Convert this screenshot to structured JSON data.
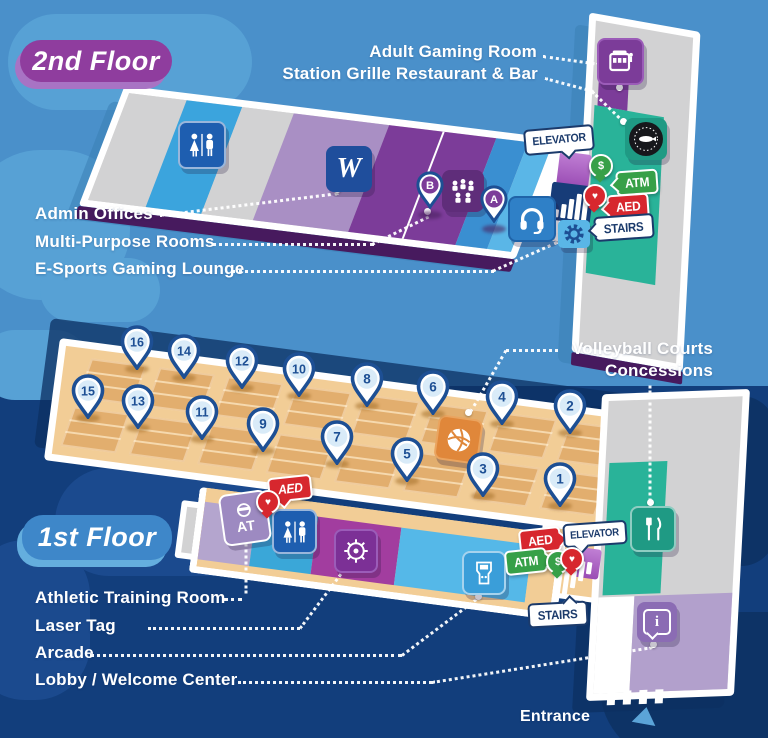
{
  "palette": {
    "sky": "#4a90ca",
    "navy": "#123e7c",
    "badge_purple": "#8f3d9e",
    "badge_blue": "#3e87c9",
    "teal": "#29b399",
    "court_tan": "#f2cd96",
    "court_dark": "#e2ae6e",
    "pin_navy": "#1d4f94",
    "atm_green": "#37a048",
    "aed_red": "#d7272e",
    "slab_edge_purple": "#471a5e",
    "laser_magenta": "#a23d9f",
    "arcade_blue": "#55b8e8",
    "lobby_lavender": "#b2a0cc"
  },
  "floor2": {
    "badge": "2nd Floor",
    "callouts": [
      {
        "id": "adult-gaming-room",
        "text": "Adult Gaming Room"
      },
      {
        "id": "station-grille",
        "text": "Station Grille Restaurant & Bar"
      },
      {
        "id": "admin-offices",
        "text": "Admin Offices"
      },
      {
        "id": "multi-purpose-rooms",
        "text": "Multi-Purpose Rooms"
      },
      {
        "id": "esports-gaming-lounge",
        "text": "E-Sports Gaming Lounge"
      }
    ],
    "admin_monogram": "W",
    "room_pins": [
      "B",
      "A"
    ]
  },
  "floor1": {
    "badge": "1st Floor",
    "callouts": [
      {
        "id": "volleyball-courts",
        "text": "Volleyball Courts"
      },
      {
        "id": "concessions",
        "text": "Concessions"
      },
      {
        "id": "athletic-training-room",
        "text": "Athletic Training Room"
      },
      {
        "id": "laser-tag",
        "text": "Laser Tag"
      },
      {
        "id": "arcade",
        "text": "Arcade"
      },
      {
        "id": "lobby-welcome-center",
        "text": "Lobby / Welcome Center"
      }
    ],
    "court_pins": [
      "16",
      "14",
      "12",
      "10",
      "8",
      "6",
      "4",
      "2",
      "15",
      "13",
      "11",
      "9",
      "7",
      "5",
      "3",
      "1"
    ],
    "at_badge": "AT",
    "entrance": "Entrance"
  },
  "signs": {
    "elevator": "ELEVATOR",
    "atm": "ATM",
    "aed": "AED",
    "stairs": "STAIRS",
    "dollar": "$"
  },
  "icons": {
    "info_glyph": "i"
  }
}
